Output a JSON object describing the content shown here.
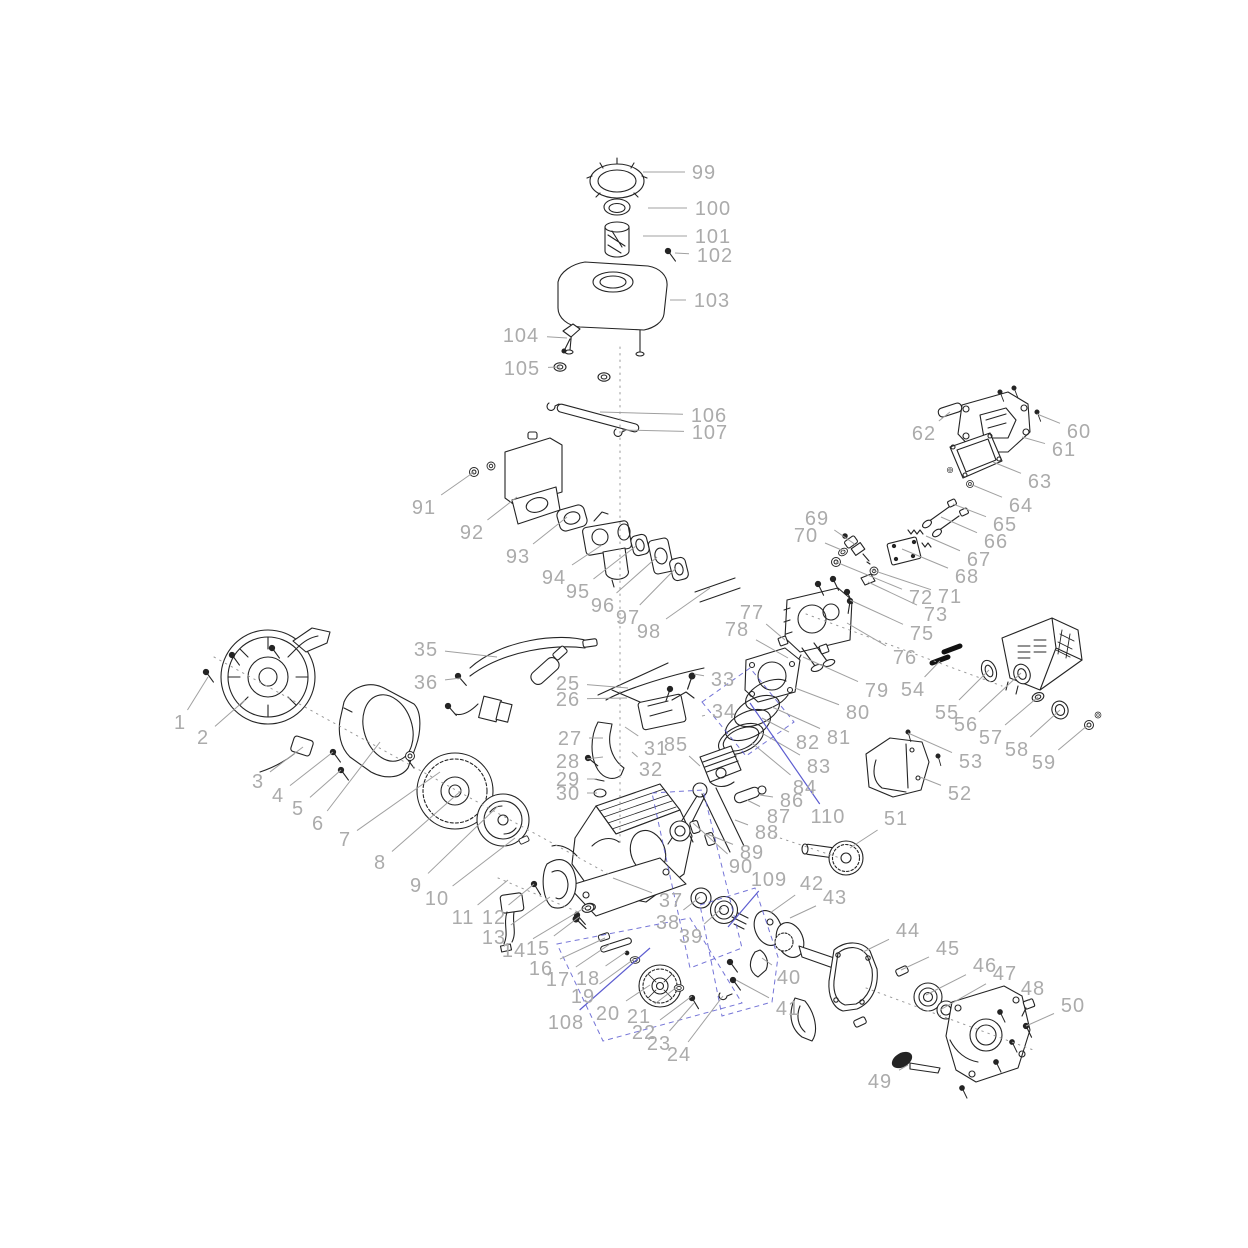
{
  "diagram": {
    "name": "small-engine-exploded-parts-diagram",
    "canvas": {
      "width": 1248,
      "height": 1248,
      "background": "#ffffff"
    },
    "style": {
      "label_color": "#ababab",
      "leader_color": "#a0a0a0",
      "blue_accent": "#5d5dd0",
      "art_color": "#242424",
      "label_font_size": 20
    },
    "labels": [
      {
        "n": "1",
        "x": 180,
        "y": 722,
        "tx": 208,
        "ty": 677
      },
      {
        "n": "2",
        "x": 203,
        "y": 737,
        "tx": 245,
        "ty": 700
      },
      {
        "n": "3",
        "x": 258,
        "y": 781,
        "tx": 303,
        "ty": 747
      },
      {
        "n": "4",
        "x": 278,
        "y": 795,
        "tx": 333,
        "ty": 752
      },
      {
        "n": "5",
        "x": 298,
        "y": 808,
        "tx": 341,
        "ty": 770
      },
      {
        "n": "6",
        "x": 318,
        "y": 823,
        "tx": 380,
        "ty": 742
      },
      {
        "n": "7",
        "x": 345,
        "y": 839,
        "tx": 440,
        "ty": 772
      },
      {
        "n": "8",
        "x": 380,
        "y": 862,
        "tx": 462,
        "ty": 790
      },
      {
        "n": "9",
        "x": 416,
        "y": 885,
        "tx": 498,
        "ty": 806
      },
      {
        "n": "10",
        "x": 437,
        "y": 898,
        "tx": 515,
        "ty": 838
      },
      {
        "n": "11",
        "x": 463,
        "y": 917,
        "tx": 508,
        "ty": 880
      },
      {
        "n": "12",
        "x": 494,
        "y": 917,
        "tx": 534,
        "ty": 884
      },
      {
        "n": "13",
        "x": 494,
        "y": 937,
        "tx": 550,
        "ty": 897
      },
      {
        "n": "14",
        "x": 514,
        "y": 950,
        "tx": 586,
        "ty": 907
      },
      {
        "n": "15",
        "x": 538,
        "y": 948,
        "tx": 579,
        "ty": 917
      },
      {
        "n": "16",
        "x": 541,
        "y": 968,
        "tx": 605,
        "ty": 938
      },
      {
        "n": "17",
        "x": 558,
        "y": 979,
        "tx": 610,
        "ty": 944
      },
      {
        "n": "18",
        "x": 588,
        "y": 978,
        "tx": 626,
        "ty": 952
      },
      {
        "n": "19",
        "x": 583,
        "y": 996,
        "tx": 634,
        "ty": 959
      },
      {
        "n": "20",
        "x": 608,
        "y": 1013,
        "tx": 650,
        "ty": 985
      },
      {
        "n": "21",
        "x": 639,
        "y": 1016,
        "tx": 677,
        "ty": 987
      },
      {
        "n": "22",
        "x": 644,
        "y": 1032,
        "tx": 692,
        "ty": 996
      },
      {
        "n": "23",
        "x": 659,
        "y": 1043,
        "tx": 694,
        "ty": 1003
      },
      {
        "n": "24",
        "x": 679,
        "y": 1054,
        "tx": 723,
        "ty": 996
      },
      {
        "n": "25",
        "x": 568,
        "y": 683,
        "tx": 628,
        "ty": 688
      },
      {
        "n": "26",
        "x": 568,
        "y": 699,
        "tx": 627,
        "ty": 698
      },
      {
        "n": "27",
        "x": 570,
        "y": 738,
        "tx": 603,
        "ty": 738
      },
      {
        "n": "28",
        "x": 568,
        "y": 761,
        "tx": 603,
        "ty": 757
      },
      {
        "n": "29",
        "x": 568,
        "y": 779,
        "tx": 597,
        "ty": 779
      },
      {
        "n": "30",
        "x": 568,
        "y": 793,
        "tx": 597,
        "ty": 793
      },
      {
        "n": "31",
        "x": 656,
        "y": 748,
        "tx": 625,
        "ty": 727
      },
      {
        "n": "32",
        "x": 651,
        "y": 769,
        "tx": 632,
        "ty": 752
      },
      {
        "n": "33",
        "x": 723,
        "y": 679,
        "tx": 694,
        "ty": 674
      },
      {
        "n": "34",
        "x": 724,
        "y": 711,
        "tx": 702,
        "ty": 716
      },
      {
        "n": "35",
        "x": 426,
        "y": 649,
        "tx": 497,
        "ty": 657
      },
      {
        "n": "36",
        "x": 426,
        "y": 682,
        "tx": 461,
        "ty": 678
      },
      {
        "n": "37",
        "x": 671,
        "y": 900,
        "tx": 613,
        "ty": 878
      },
      {
        "n": "38",
        "x": 668,
        "y": 922,
        "tx": 700,
        "ty": 897
      },
      {
        "n": "39",
        "x": 691,
        "y": 936,
        "tx": 722,
        "ty": 908
      },
      {
        "n": "40",
        "x": 789,
        "y": 977,
        "tx": 762,
        "ty": 958
      },
      {
        "n": "41",
        "x": 788,
        "y": 1008,
        "tx": 736,
        "ty": 980
      },
      {
        "n": "42",
        "x": 812,
        "y": 883,
        "tx": 770,
        "ty": 913
      },
      {
        "n": "43",
        "x": 835,
        "y": 897,
        "tx": 790,
        "ty": 918
      },
      {
        "n": "44",
        "x": 908,
        "y": 930,
        "tx": 863,
        "ty": 952
      },
      {
        "n": "45",
        "x": 948,
        "y": 948,
        "tx": 901,
        "ty": 970
      },
      {
        "n": "46",
        "x": 985,
        "y": 965,
        "tx": 926,
        "ty": 995
      },
      {
        "n": "47",
        "x": 1005,
        "y": 973,
        "tx": 940,
        "ty": 1010
      },
      {
        "n": "48",
        "x": 1033,
        "y": 988,
        "tx": 1029,
        "ty": 1001
      },
      {
        "n": "49",
        "x": 880,
        "y": 1081,
        "tx": 908,
        "ty": 1065
      },
      {
        "n": "50",
        "x": 1073,
        "y": 1005,
        "tx": 1026,
        "ty": 1026
      },
      {
        "n": "51",
        "x": 896,
        "y": 818,
        "tx": 850,
        "ty": 848
      },
      {
        "n": "52",
        "x": 960,
        "y": 793,
        "tx": 920,
        "ty": 777
      },
      {
        "n": "53",
        "x": 971,
        "y": 761,
        "tx": 908,
        "ty": 733
      },
      {
        "n": "54",
        "x": 913,
        "y": 689,
        "tx": 940,
        "ty": 661
      },
      {
        "n": "55",
        "x": 947,
        "y": 712,
        "tx": 989,
        "ty": 670
      },
      {
        "n": "56",
        "x": 966,
        "y": 724,
        "tx": 1021,
        "ty": 673
      },
      {
        "n": "57",
        "x": 991,
        "y": 737,
        "tx": 1038,
        "ty": 697
      },
      {
        "n": "58",
        "x": 1017,
        "y": 749,
        "tx": 1060,
        "ty": 710
      },
      {
        "n": "59",
        "x": 1044,
        "y": 762,
        "tx": 1088,
        "ty": 725
      },
      {
        "n": "60",
        "x": 1079,
        "y": 431,
        "tx": 1037,
        "ty": 414
      },
      {
        "n": "61",
        "x": 1064,
        "y": 449,
        "tx": 1022,
        "ty": 437
      },
      {
        "n": "62",
        "x": 924,
        "y": 433,
        "tx": 950,
        "ty": 412
      },
      {
        "n": "63",
        "x": 1040,
        "y": 481,
        "tx": 993,
        "ty": 462
      },
      {
        "n": "64",
        "x": 1021,
        "y": 505,
        "tx": 970,
        "ty": 484
      },
      {
        "n": "65",
        "x": 1005,
        "y": 524,
        "tx": 953,
        "ty": 504
      },
      {
        "n": "66",
        "x": 996,
        "y": 541,
        "tx": 941,
        "ty": 517
      },
      {
        "n": "67",
        "x": 979,
        "y": 559,
        "tx": 926,
        "ty": 536
      },
      {
        "n": "68",
        "x": 967,
        "y": 576,
        "tx": 902,
        "ty": 549
      },
      {
        "n": "69",
        "x": 817,
        "y": 518,
        "tx": 856,
        "ty": 545
      },
      {
        "n": "70",
        "x": 806,
        "y": 535,
        "tx": 844,
        "ty": 551
      },
      {
        "n": "71",
        "x": 950,
        "y": 596,
        "tx": 872,
        "ty": 570
      },
      {
        "n": "72",
        "x": 921,
        "y": 597,
        "tx": 836,
        "ty": 562
      },
      {
        "n": "73",
        "x": 936,
        "y": 614,
        "tx": 868,
        "ty": 582
      },
      {
        "n": "75",
        "x": 922,
        "y": 633,
        "tx": 850,
        "ty": 600
      },
      {
        "n": "76",
        "x": 905,
        "y": 657,
        "tx": 847,
        "ty": 623
      },
      {
        "n": "77",
        "x": 752,
        "y": 612,
        "tx": 785,
        "ty": 640
      },
      {
        "n": "78",
        "x": 737,
        "y": 629,
        "tx": 788,
        "ty": 658
      },
      {
        "n": "79",
        "x": 877,
        "y": 690,
        "tx": 803,
        "ty": 657
      },
      {
        "n": "80",
        "x": 858,
        "y": 712,
        "tx": 795,
        "ty": 688
      },
      {
        "n": "81",
        "x": 839,
        "y": 737,
        "tx": 772,
        "ty": 707
      },
      {
        "n": "82",
        "x": 808,
        "y": 742,
        "tx": 762,
        "ty": 718
      },
      {
        "n": "83",
        "x": 819,
        "y": 766,
        "tx": 760,
        "ty": 732
      },
      {
        "n": "84",
        "x": 805,
        "y": 787,
        "tx": 752,
        "ty": 743
      },
      {
        "n": "85",
        "x": 676,
        "y": 744,
        "tx": 700,
        "ty": 766
      },
      {
        "n": "86",
        "x": 792,
        "y": 800,
        "tx": 760,
        "ty": 795
      },
      {
        "n": "87",
        "x": 779,
        "y": 816,
        "tx": 747,
        "ty": 800
      },
      {
        "n": "88",
        "x": 767,
        "y": 832,
        "tx": 735,
        "ty": 820
      },
      {
        "n": "89",
        "x": 752,
        "y": 852,
        "tx": 707,
        "ty": 834
      },
      {
        "n": "90",
        "x": 741,
        "y": 866,
        "tx": 693,
        "ty": 823
      },
      {
        "n": "91",
        "x": 424,
        "y": 507,
        "tx": 474,
        "ty": 472
      },
      {
        "n": "92",
        "x": 472,
        "y": 532,
        "tx": 517,
        "ty": 497
      },
      {
        "n": "93",
        "x": 518,
        "y": 556,
        "tx": 567,
        "ty": 517
      },
      {
        "n": "94",
        "x": 554,
        "y": 577,
        "tx": 602,
        "ty": 545
      },
      {
        "n": "95",
        "x": 578,
        "y": 591,
        "tx": 636,
        "ty": 546
      },
      {
        "n": "96",
        "x": 603,
        "y": 605,
        "tx": 657,
        "ty": 557
      },
      {
        "n": "97",
        "x": 628,
        "y": 617,
        "tx": 676,
        "ty": 568
      },
      {
        "n": "98",
        "x": 649,
        "y": 631,
        "tx": 710,
        "ty": 588
      },
      {
        "n": "99",
        "x": 704,
        "y": 172,
        "tx": 643,
        "ty": 172
      },
      {
        "n": "100",
        "x": 713,
        "y": 208,
        "tx": 648,
        "ty": 208
      },
      {
        "n": "101",
        "x": 713,
        "y": 236,
        "tx": 643,
        "ty": 236
      },
      {
        "n": "102",
        "x": 715,
        "y": 255,
        "tx": 675,
        "ty": 253
      },
      {
        "n": "103",
        "x": 712,
        "y": 300,
        "tx": 670,
        "ty": 300
      },
      {
        "n": "104",
        "x": 521,
        "y": 335,
        "tx": 567,
        "ty": 338
      },
      {
        "n": "105",
        "x": 522,
        "y": 368,
        "tx": 560,
        "ty": 367
      },
      {
        "n": "106",
        "x": 709,
        "y": 415,
        "tx": 600,
        "ty": 412
      },
      {
        "n": "107",
        "x": 710,
        "y": 432,
        "tx": 622,
        "ty": 430
      },
      {
        "n": "108",
        "x": 566,
        "y": 1022,
        "tx": 650,
        "ty": 948,
        "blue": 1
      },
      {
        "n": "109",
        "x": 769,
        "y": 879,
        "tx": 728,
        "ty": 927,
        "blue": 1
      },
      {
        "n": "110",
        "x": 828,
        "y": 816,
        "tx": 750,
        "ty": 703,
        "blue": 1
      }
    ],
    "dotted_guides": [
      [
        620,
        347,
        620,
        843
      ],
      [
        214,
        657,
        612,
        876
      ],
      [
        806,
        614,
        1002,
        686
      ],
      [
        866,
        988,
        1036,
        1051
      ],
      [
        768,
        834,
        840,
        858
      ],
      [
        498,
        878,
        578,
        912
      ]
    ],
    "dashed_groups": [
      "702,702 750,668 794,722 746,756",
      "652,793 703,790 742,948 690,968",
      "557,944 690,918 742,1003 603,1041",
      "700,905 755,888 778,957 772,1002 722,1016"
    ]
  }
}
